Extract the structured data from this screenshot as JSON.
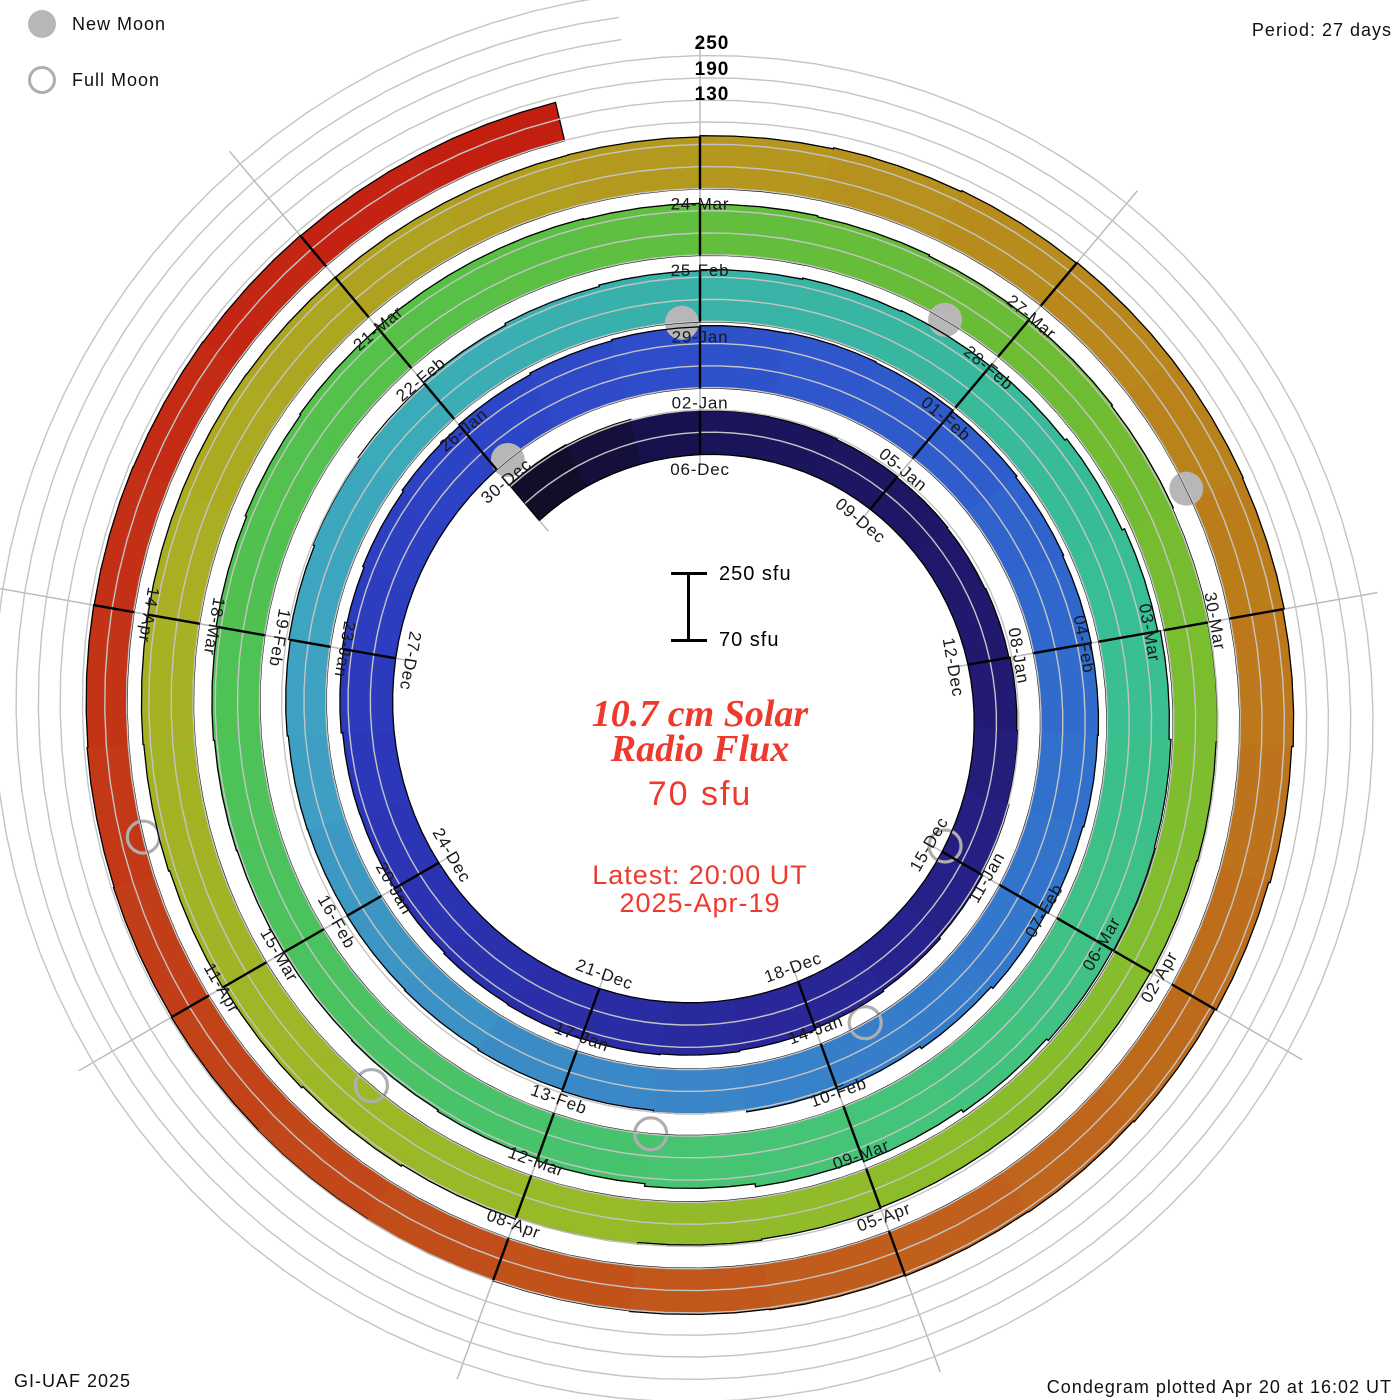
{
  "legend": {
    "new_moon": "New Moon",
    "full_moon": "Full Moon"
  },
  "header": {
    "period_label": "Period: 27 days"
  },
  "axis_labels": [
    "250",
    "190",
    "130"
  ],
  "center": {
    "scale_top": "250 sfu",
    "scale_bottom": "70 sfu",
    "title_line1": "10.7 cm Solar",
    "title_line2": "Radio Flux",
    "latest_value": "70 sfu",
    "latest_line1": "Latest: 20:00 UT",
    "latest_line2": "2025-Apr-19"
  },
  "footer": {
    "left": "GI-UAF 2025",
    "right": "Condegram plotted Apr 20 at 16:02 UT"
  },
  "chart_data": {
    "type": "spiral_bar",
    "subtype": "condegram",
    "title": "10.7 cm Solar Radio Flux",
    "units": "sfu",
    "period_days": 27,
    "direction": "clockwise",
    "start_date": "2024-Dec-03",
    "end_date": "2025-Apr-19",
    "latest_value_sfu": 70,
    "flux_baseline_sfu": 70,
    "gridlines_sfu": [
      130,
      190,
      250
    ],
    "tick_interval_days": 3,
    "flux_sfu": [
      195,
      193,
      190,
      188,
      186,
      184,
      182,
      180,
      182,
      185,
      188,
      192,
      196,
      200,
      204,
      208,
      211,
      213,
      214,
      212,
      209,
      207,
      208,
      212,
      216,
      220,
      224,
      228,
      232,
      235,
      238,
      240,
      238,
      235,
      231,
      228,
      226,
      224,
      221,
      216,
      210,
      203,
      196,
      190,
      185,
      181,
      178,
      176,
      175,
      176,
      179,
      183,
      188,
      193,
      198,
      203,
      207,
      210,
      213,
      215,
      218,
      224,
      231,
      238,
      243,
      245,
      242,
      236,
      228,
      220,
      212,
      205,
      200,
      196,
      194,
      194,
      196,
      199,
      203,
      207,
      210,
      212,
      212,
      210,
      207,
      204,
      201,
      198,
      195,
      192,
      189,
      186,
      184,
      182,
      181,
      181,
      183,
      186,
      190,
      194,
      198,
      202,
      205,
      208,
      210,
      211,
      211,
      210,
      209,
      209,
      210,
      213,
      216,
      219,
      221,
      221,
      219,
      215,
      211,
      207,
      203,
      200,
      198,
      196,
      194,
      192,
      190,
      188,
      186,
      184,
      182,
      180,
      179,
      178,
      177,
      176,
      176,
      70
    ],
    "tick_labels": [
      "06-Dec",
      "09-Dec",
      "12-Dec",
      "15-Dec",
      "18-Dec",
      "21-Dec",
      "24-Dec",
      "27-Dec",
      "30-Dec",
      "02-Jan",
      "05-Jan",
      "08-Jan",
      "11-Jan",
      "14-Jan",
      "17-Jan",
      "20-Jan",
      "23-Jan",
      "26-Jan",
      "29-Jan",
      "01-Feb",
      "04-Feb",
      "07-Feb",
      "10-Feb",
      "13-Feb",
      "16-Feb",
      "19-Feb",
      "22-Feb",
      "25-Feb",
      "28-Feb",
      "03-Mar",
      "06-Mar",
      "09-Mar",
      "12-Mar",
      "15-Mar",
      "18-Mar",
      "21-Mar",
      "24-Mar",
      "27-Mar",
      "30-Mar",
      "02-Apr",
      "05-Apr",
      "08-Apr",
      "11-Apr",
      "14-Apr"
    ],
    "first_label_day_index": 3,
    "color_anchors": [
      [
        0,
        "#0e0d20"
      ],
      [
        3,
        "#191356"
      ],
      [
        9,
        "#221a70"
      ],
      [
        15,
        "#292698"
      ],
      [
        21,
        "#2c34b4"
      ],
      [
        27,
        "#2d44c6"
      ],
      [
        33,
        "#2f5ccc"
      ],
      [
        39,
        "#3276cc"
      ],
      [
        45,
        "#3b8ac6"
      ],
      [
        51,
        "#3fa4c2"
      ],
      [
        54,
        "#3aacb8"
      ],
      [
        57,
        "#38b2a8"
      ],
      [
        63,
        "#38bf92"
      ],
      [
        69,
        "#44c478"
      ],
      [
        75,
        "#4ac25e"
      ],
      [
        81,
        "#54c148"
      ],
      [
        87,
        "#6cbc34"
      ],
      [
        93,
        "#84bd2c"
      ],
      [
        99,
        "#98ba28"
      ],
      [
        105,
        "#a8b022"
      ],
      [
        111,
        "#b4981e"
      ],
      [
        117,
        "#bc7a1a"
      ],
      [
        123,
        "#c05e1c"
      ],
      [
        129,
        "#c24018"
      ],
      [
        135,
        "#c42414"
      ],
      [
        137,
        "#c21d10"
      ]
    ],
    "moons": {
      "new_days": [
        27.2,
        56.8,
        86.4,
        115.9
      ],
      "new_dates": [
        "2024-Dec-30",
        "2025-Jan-29",
        "2025-Feb-28",
        "2025-Mar-29"
      ],
      "full_days": [
        11.9,
        41.4,
        71.0,
        100.6,
        130.3
      ],
      "full_dates": [
        "2024-Dec-15",
        "2025-Jan-13",
        "2025-Feb-12",
        "2025-Mar-14",
        "2025-Apr-13"
      ]
    },
    "colors": {
      "gridline": "#c4c4c4",
      "radial_tick": "#b8b8b8",
      "bar_edge": "#000000",
      "day_tick": "#000000",
      "label_text": "#191919",
      "moon_fill": "#b7b7b7",
      "moon_ring": "#aeaeae",
      "accent_red": "#ee3a2e",
      "background": "#ffffff"
    }
  }
}
